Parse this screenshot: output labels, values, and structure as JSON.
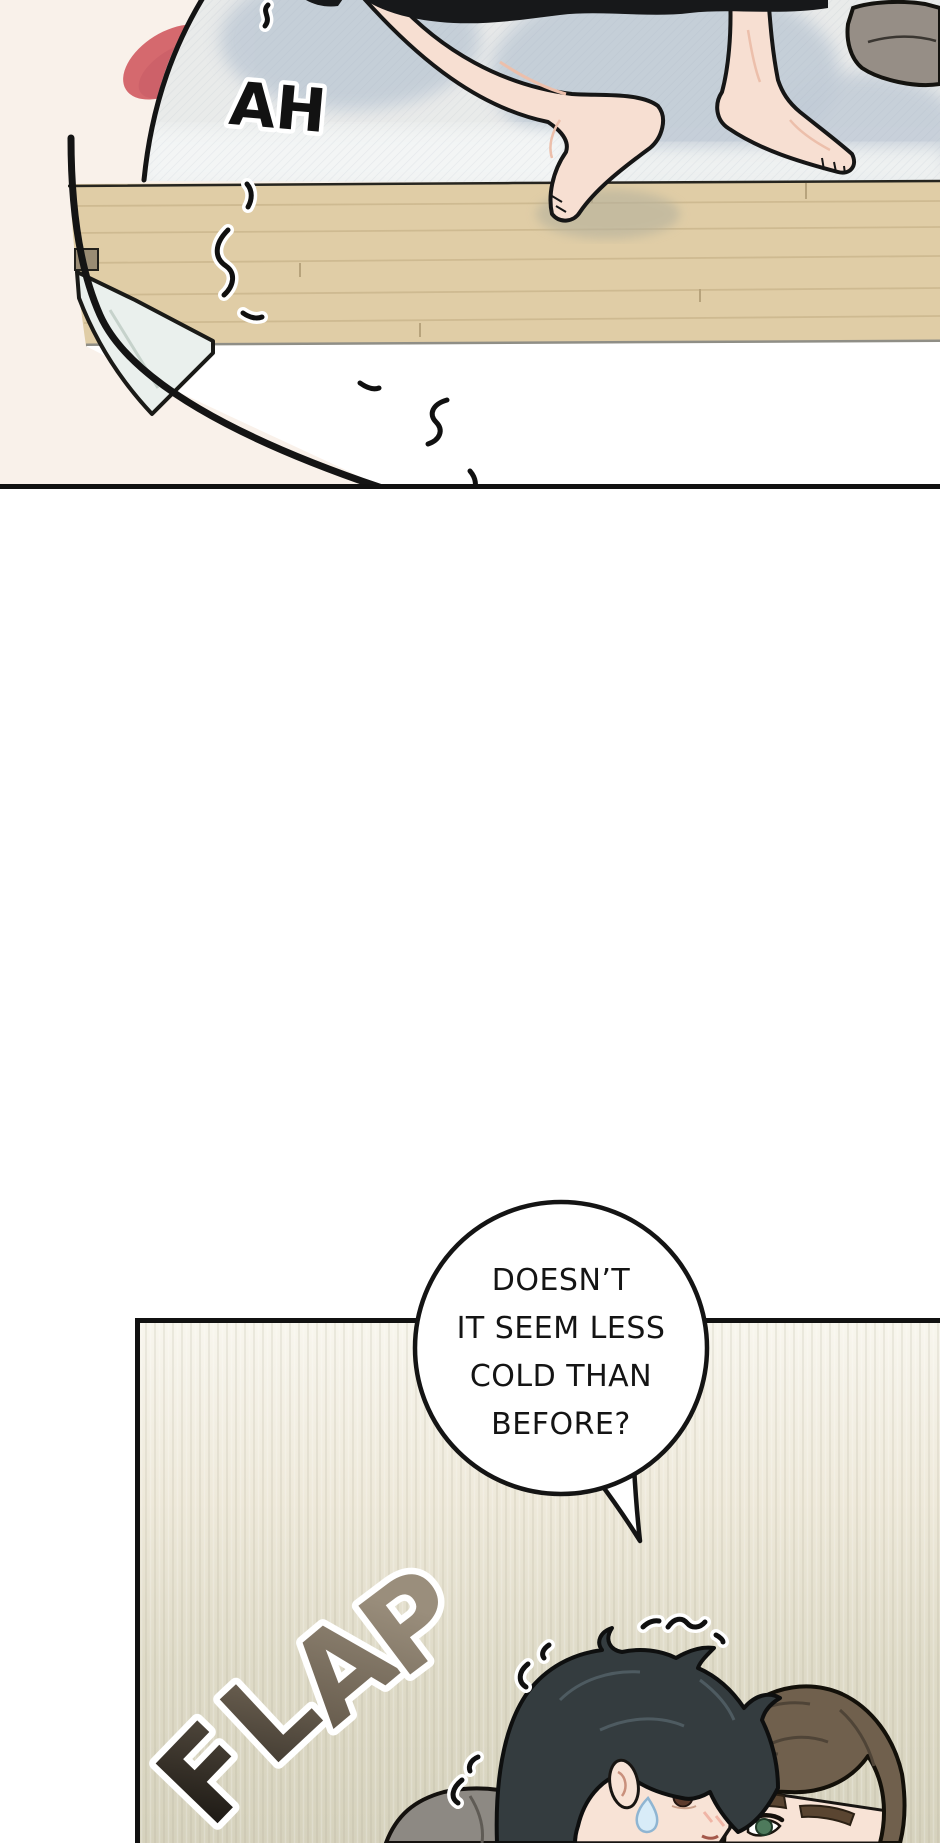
{
  "page": {
    "kind": "webtoon-comic-page",
    "width": 940,
    "height": 1843,
    "background": "#ffffff"
  },
  "panel_bed_scene": {
    "sfx_ah": "AH",
    "colors": {
      "wall": "#f9f1ea",
      "bedding": "#e9ebea",
      "bedding_shadow": "#c2ccd7",
      "clothing_black": "#17181a",
      "skin": "#f7dfd2",
      "cushion_gray": "#968e86",
      "wood_floor": "#e0cda6",
      "red_object": "#d5696e",
      "hanging_sheet": "#ffffff"
    }
  },
  "speech_bubble": {
    "lines": [
      "DOESN’T",
      "IT SEEM LESS",
      "COLD THAN",
      "BEFORE?"
    ],
    "fill": "#ffffff",
    "outline": "#141414"
  },
  "panel_room_scene": {
    "sfx_flap": {
      "word": "FLAP",
      "letters": [
        "F",
        "L",
        "A",
        "P"
      ],
      "color_dark": "#16130f",
      "color_light": "#9a8e7c"
    },
    "colors": {
      "bg_top": "#f8f6ee",
      "bg_bottom": "#d6d2bd",
      "front_hair": "#343c3f",
      "back_hair": "#70604d",
      "skin": "#f8e3d6",
      "eye_brown": "#5d3a2c",
      "eye_green": "#4e7a5c",
      "collar_gray": "#8d8983",
      "sweat_drop": "#d8ecf8"
    }
  }
}
